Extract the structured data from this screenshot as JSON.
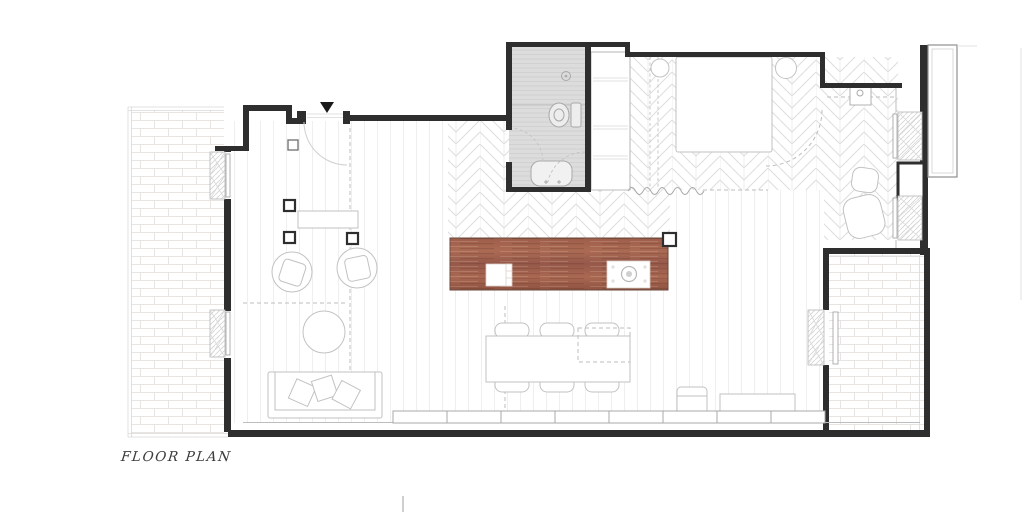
{
  "title": {
    "label": "FLOOR PLAN"
  },
  "colors": {
    "wall": "#2e2e2e",
    "lineLight": "#bdbdbd",
    "lineFaint": "#d9d9d9",
    "furniture": "#c2c2c2",
    "fixture": "#a9a9a9",
    "bathFill": "#dcdcdc",
    "bathLine": "#cccccc",
    "wood": "#a3624e",
    "woodDark": "#8c5240",
    "marker": "#1a1a1a",
    "text": "#3b3b3b",
    "herringbone": "#dedede",
    "brick": "#e7e4e1",
    "plank": "#efefef"
  },
  "plan": {
    "rooms": [
      "terrace-left",
      "living-room",
      "dining-area",
      "kitchen",
      "bathroom",
      "wardrobe",
      "bedroom",
      "terrace-right"
    ],
    "symbols": [
      "entry-direction-marker",
      "entry-door-swing",
      "structural-columns",
      "console-shelf",
      "armchairs",
      "coffee-table",
      "sofa",
      "throw-pillows",
      "dining-table",
      "dining-chairs",
      "kitchen-island",
      "island-sink",
      "island-cooktop",
      "shower-drain",
      "toilet",
      "washbasin",
      "bathroom-door-swing",
      "wardrobe-shelves",
      "bed",
      "bedside-tables",
      "curtain",
      "vanity-basin",
      "lounge-chair",
      "window-shutters",
      "glazed-facade-panels",
      "planter-bench",
      "cabinet-unit",
      "exterior-sliding-panel"
    ]
  }
}
